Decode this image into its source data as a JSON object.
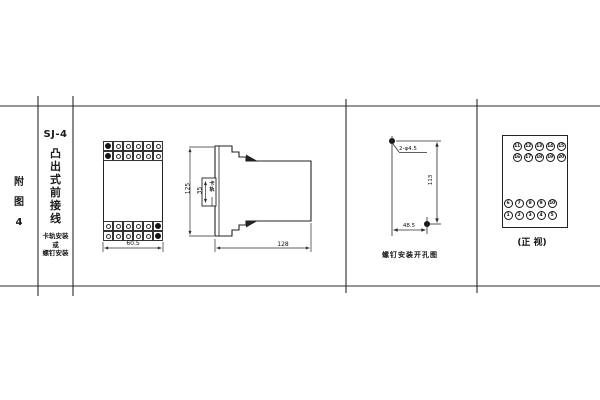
{
  "title_block": {
    "figure_chars": [
      "附",
      "图",
      "4"
    ],
    "model": "SJ-4",
    "type_chars": [
      "凸",
      "出",
      "式",
      "前",
      "接",
      "线"
    ],
    "mount_lines": [
      "卡轨安装",
      "或",
      "螺钉安装"
    ]
  },
  "front_view": {
    "width_dim": "60.5",
    "terminal_columns": 6,
    "terminal_rows_per_block": 2
  },
  "side_view": {
    "height_dim": "125",
    "clip_dim": "35",
    "clip_label": "卡轨",
    "depth_dim": "128"
  },
  "drill_view": {
    "holes_label": "2-φ4.5",
    "vertical_dim": "113",
    "horizontal_dim": "48.5",
    "caption": "螺钉安装开孔图"
  },
  "terminal_view": {
    "top_rows": [
      [
        "11",
        "12",
        "13",
        "14",
        "15"
      ],
      [
        "16",
        "17",
        "18",
        "19",
        "20"
      ]
    ],
    "bottom_rows": [
      [
        "6",
        "7",
        "8",
        "9",
        "10"
      ],
      [
        "1",
        "2",
        "3",
        "4",
        "5"
      ]
    ],
    "caption": "(正 视)"
  },
  "colors": {
    "line": "#2b2b2b",
    "background": "#ffffff"
  }
}
